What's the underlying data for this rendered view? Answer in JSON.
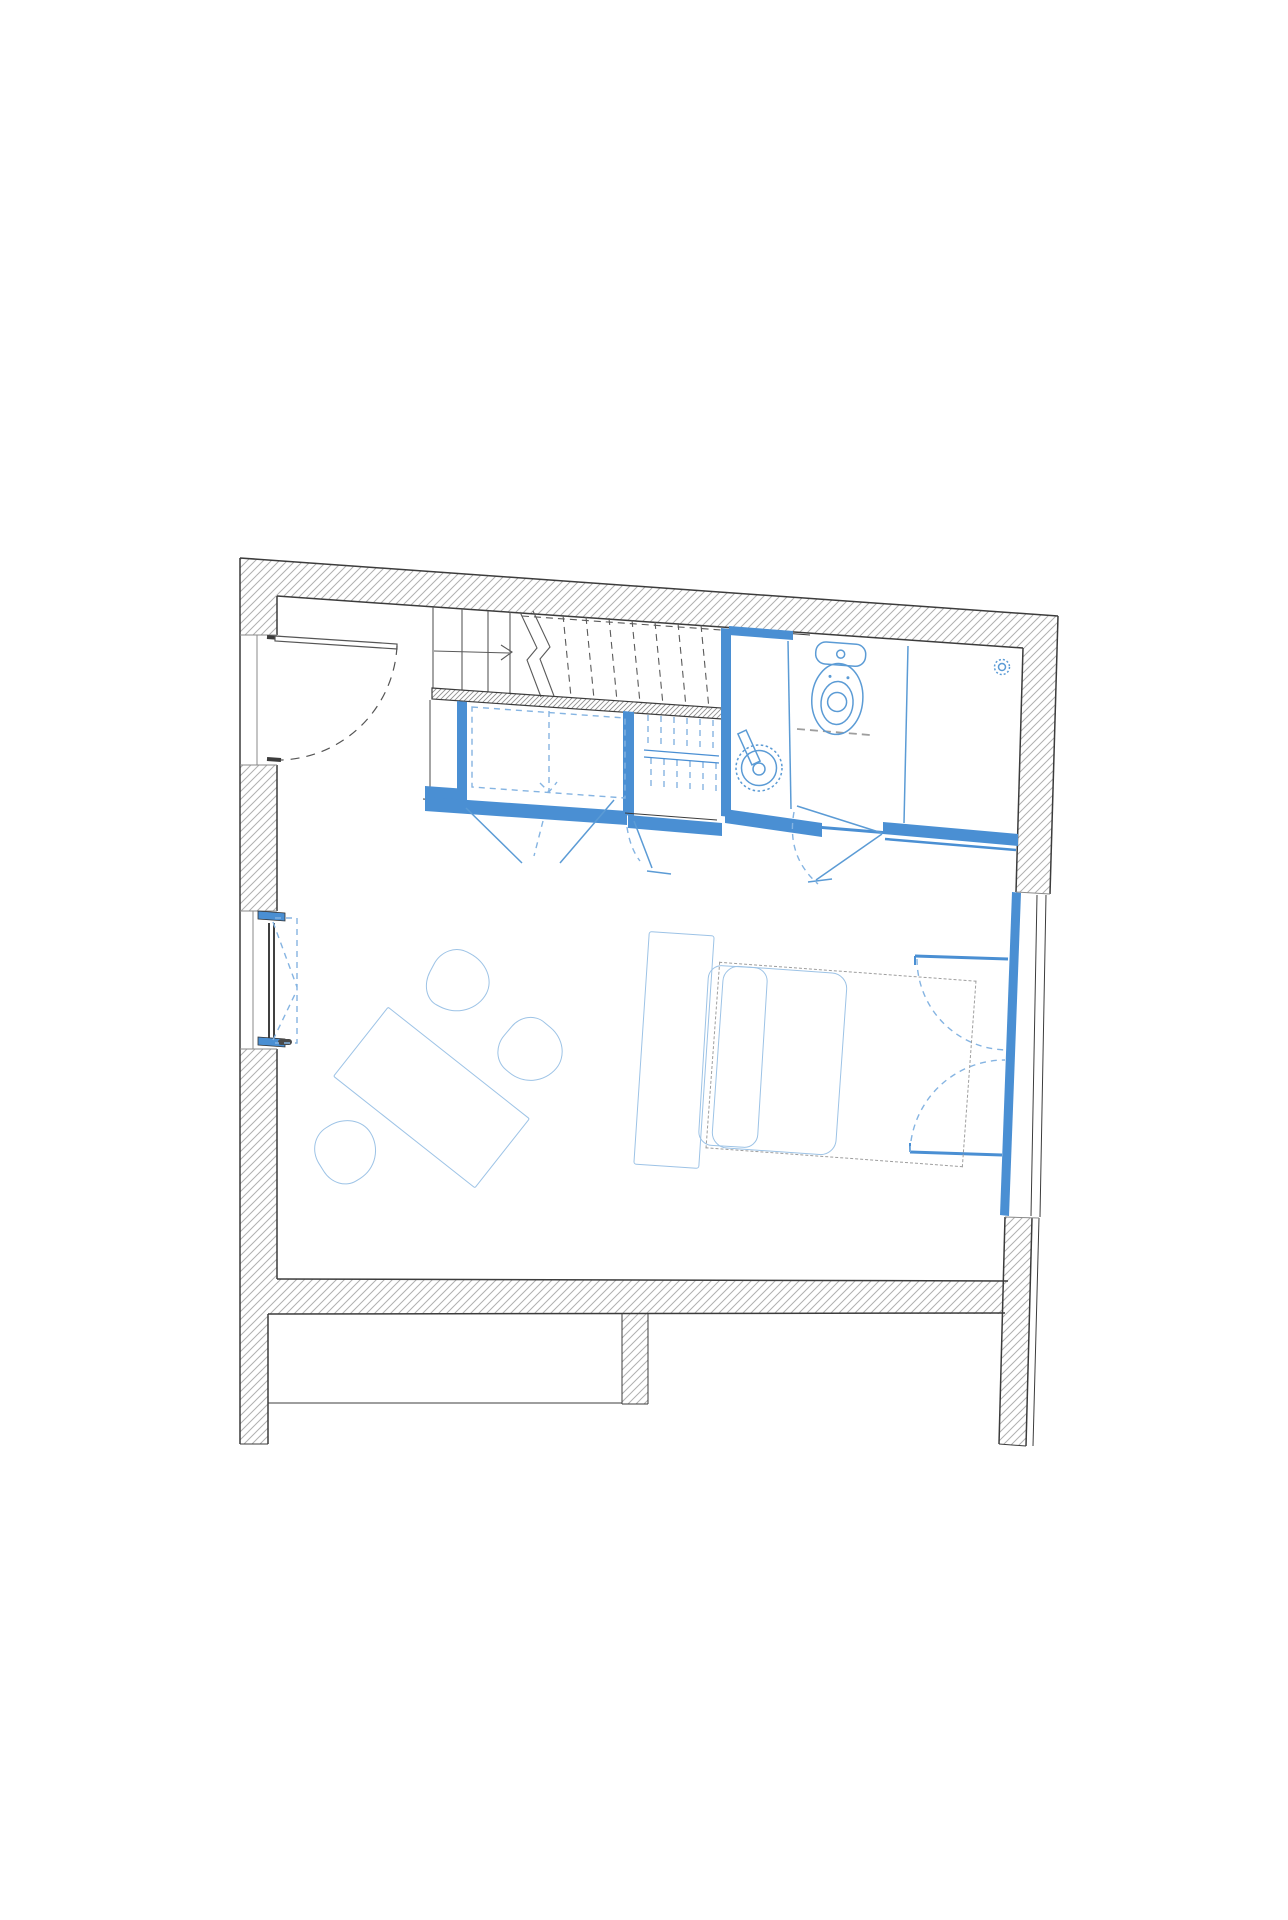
{
  "document": {
    "kind": "architectural-floor-plan",
    "visible_text": "none",
    "description": "Single-storey apartment plan; grey hatched existing walls, blue new partitions and fixtures"
  },
  "palette": {
    "background": "#ffffff",
    "wall_line": "#3c3c3c",
    "stair_line": "#5a5a5a",
    "hatch": "#b0b0b0",
    "hatch_fine": "#8f8f8f",
    "accent_blue": "#4a8fd3",
    "fixture_blue": "#5b9bd5",
    "dashed_blue": "#85b4e2",
    "furniture_blue": "#9dc3e6",
    "dashed_gray": "#9e9e9e"
  },
  "elements": {
    "structure": [
      "exterior-wall-top",
      "exterior-wall-left",
      "exterior-wall-right",
      "interior-wall-band",
      "wall-pier",
      "lower-rooms"
    ],
    "circulation": [
      "staircase",
      "stair-direction-arrow",
      "stair-break-symbol",
      "loft-ladder"
    ],
    "openings": [
      "entry-door",
      "tilt-turn-window-left",
      "french-window-right",
      "bathroom-door",
      "wardrobe-doors"
    ],
    "bathroom": [
      "toilet",
      "washbasin",
      "basin-tap",
      "shower-drain",
      "wc-partition",
      "shower-partition"
    ],
    "furniture": [
      "wardrobe",
      "bed",
      "pillow",
      "duvet",
      "desk",
      "dining-table",
      "chair",
      "chair",
      "chair"
    ]
  }
}
